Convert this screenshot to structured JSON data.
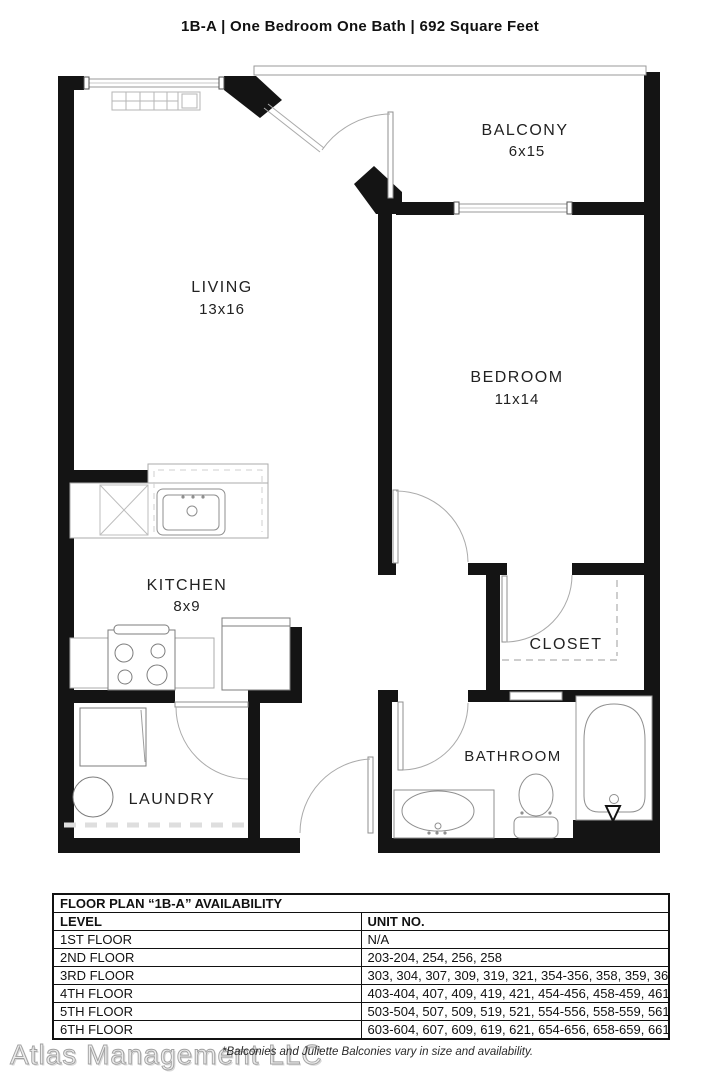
{
  "header": {
    "title": "1B-A | One Bedroom One Bath | 692 Square Feet"
  },
  "rooms": {
    "living": {
      "name": "LIVING",
      "dims": "13x16"
    },
    "balcony": {
      "name": "BALCONY",
      "dims": "6x15"
    },
    "bedroom": {
      "name": "BEDROOM",
      "dims": "11x14"
    },
    "kitchen": {
      "name": "KITCHEN",
      "dims": "8x9"
    },
    "closet": {
      "name": "CLOSET"
    },
    "bathroom": {
      "name": "BATHROOM"
    },
    "laundry": {
      "name": "LAUNDRY"
    }
  },
  "availability_table": {
    "title": "FLOOR PLAN “1B-A” AVAILABILITY",
    "columns": {
      "level": "LEVEL",
      "units": "UNIT NO."
    },
    "rows": [
      {
        "level": "1ST FLOOR",
        "units": "N/A"
      },
      {
        "level": "2ND FLOOR",
        "units": "203-204, 254, 256, 258"
      },
      {
        "level": "3RD FLOOR",
        "units": "303, 304, 307, 309, 319, 321, 354-356, 358, 359, 361"
      },
      {
        "level": "4TH FLOOR",
        "units": "403-404, 407, 409, 419, 421, 454-456, 458-459, 461"
      },
      {
        "level": "5TH FLOOR",
        "units": "503-504, 507, 509, 519, 521, 554-556, 558-559, 561"
      },
      {
        "level": "6TH FLOOR",
        "units": "603-604, 607, 609, 619, 621, 654-656, 658-659, 661"
      }
    ]
  },
  "footer": {
    "watermark": "Atlas Management LLC",
    "note": "*Balconies and Juliette Balconies vary in size and availability."
  },
  "colors": {
    "wall": "#141414",
    "fixture": "#8f8f8f",
    "text": "#1d1d1d",
    "background": "#ffffff"
  }
}
